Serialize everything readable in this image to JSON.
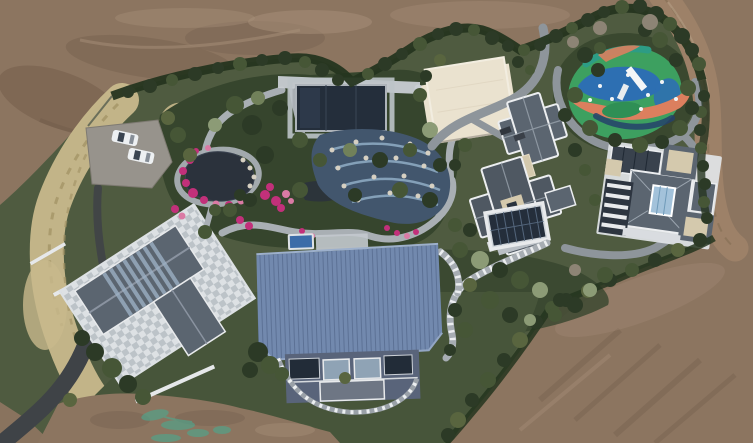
{
  "scene": {
    "type": "aerial drone photograph",
    "subject": "Luxury hillside estate with landscaped gardens, ponds, playground and villas, surrounded by graded bare earth",
    "lighting": "overcast daylight, top-down view",
    "features": [
      {
        "name": "bare-earth",
        "label": "Graded brown earth surrounding the grounds on the north, east and south"
      },
      {
        "name": "boundary-hedge",
        "label": "Dark clipped hedge and tree line enclosing the landscaped grounds"
      },
      {
        "name": "dirt-road",
        "label": "Unpaved access road curving along the north-east corner"
      },
      {
        "name": "asphalt-driveway",
        "label": "Dark asphalt driveway entering from the south-west corner"
      },
      {
        "name": "parking-pad",
        "label": "Gravel parking pad with two white cars parked nose-in"
      },
      {
        "name": "dry-grass-bank",
        "label": "Band of tan ornamental grasses along the west boundary"
      },
      {
        "name": "stone-plaza",
        "label": "Light checkered stone plaza around the west house"
      },
      {
        "name": "west-house",
        "label": "West house with grey gabled roof and glass skylight strips"
      },
      {
        "name": "ornamental-garden",
        "label": "Ornamental garden with winding grey stone paths"
      },
      {
        "name": "koi-pond",
        "label": "Dark kidney-shaped pond ringed with magenta azalea blooms"
      },
      {
        "name": "glass-pavilion",
        "label": "Dark glass-roofed pavilion with pale stone border"
      },
      {
        "name": "water-terraces",
        "label": "Cascading blue water terraces edged with white rocks"
      },
      {
        "name": "blue-barn",
        "label": "Large barn-style building with blue standing-seam metal roof and glazed facade"
      },
      {
        "name": "barn-pool",
        "label": "Small blue plunge pool at the barn's north-west corner"
      },
      {
        "name": "curved-walk",
        "label": "White-dotted curved walk wrapping the barn's south facade"
      },
      {
        "name": "cream-court",
        "label": "Cream flat-roofed sport court building"
      },
      {
        "name": "garden-lane",
        "label": "Grey paved lane winding between court, villas and playground"
      },
      {
        "name": "playground",
        "label": "Playground with swirling green, blue and orange safety surface and white slide"
      },
      {
        "name": "villa-center",
        "label": "Central villa with interlocking grey hip roofs, white ridge trim and beige terraces"
      },
      {
        "name": "villa-east",
        "label": "East villa with grey roofs around a glazed central courtyard"
      },
      {
        "name": "glass-roof-annex",
        "label": "Small annex with dark glazed roof south of the central villa"
      },
      {
        "name": "balustrade-walk",
        "label": "Stone balustraded walk stepping down toward the barn"
      },
      {
        "name": "shrub-garden",
        "label": "South-east shrub garden of clipped evergreens"
      },
      {
        "name": "lawn",
        "label": "Dark green lawn sweeping around the barn"
      },
      {
        "name": "dirt-patch-south",
        "label": "Bare dirt patch at the south edge with teal survey paint marks"
      }
    ]
  },
  "palette": {
    "dirt_base": "#8c7560",
    "dirt_dark": "#6e5948",
    "dirt_light": "#a8907a",
    "dirt_road": "#9d8168",
    "green_base": "#4f5b40",
    "green_dark": "#36452d",
    "lawn": "#47553a",
    "hedge": "#25351f",
    "tan_grass": "#c8b98c",
    "tan_grass_dark": "#9f9063",
    "path_gray": "#a9afb4",
    "road_asphalt": "#3f4347",
    "plaza_light": "#dde1e4",
    "plaza_mid": "#bcc3c8",
    "roof_slate": "#5b6570",
    "roof_slate_dark": "#4f5862",
    "roof_trim": "#eceef0",
    "roof_beige": "#d4c9ad",
    "roof_blue": "#7289ae",
    "roof_blue_seam": "#5c7195",
    "barn_wall": "#59647a",
    "water_dark": "#2b323c",
    "water_blue": "#42566d",
    "water_arc": "#84a0b8",
    "pool_blue": "#3c6ca8",
    "glass_dark": "#242e3b",
    "court_cream": "#eae2cf",
    "play_green": "#3da060",
    "play_blue": "#2d6fb2",
    "play_orange": "#dc7f5e",
    "play_teal": "#2d9c85",
    "car_white": "#edf0f2",
    "mark_teal": "#4fa58c",
    "tree_dark": "#2c3a26",
    "tree_mid": "#465636",
    "tree_light": "#71815a",
    "tree_sage": "#8c9b76",
    "tree_olive": "#59653f",
    "tree_bare": "#8d8475",
    "flower_magenta": "#c2307a",
    "flower_pink": "#da7aa4",
    "rock": "#d6d0c2"
  }
}
